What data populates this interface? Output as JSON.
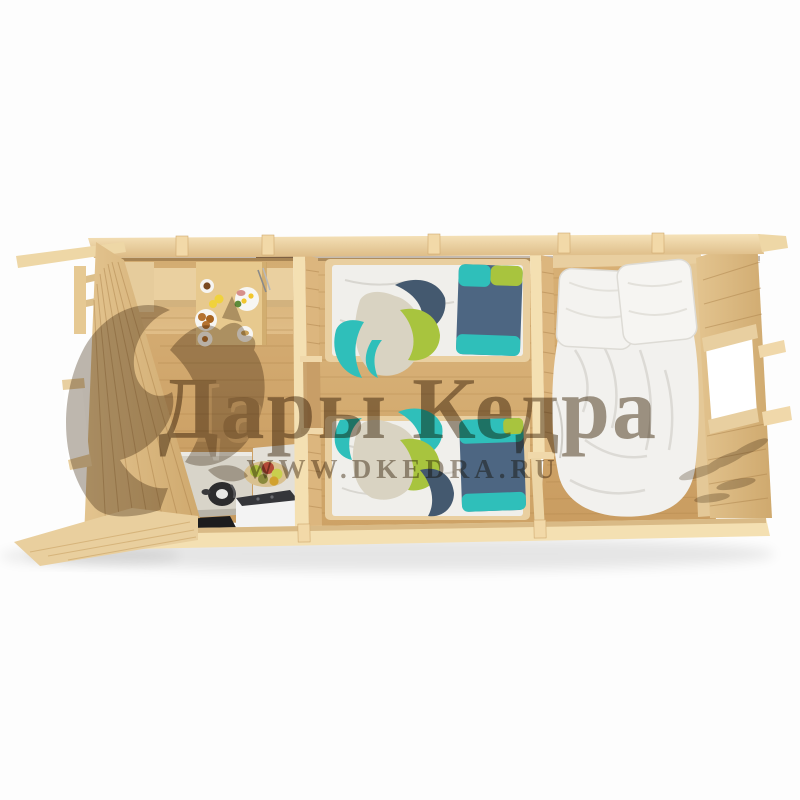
{
  "watermark": {
    "brand_text": "Дары Кедра",
    "url_text": "WWW.DKEDRA.RU",
    "logo": "squirrel-silhouette-icon",
    "brand_color": "#a39889",
    "url_color": "#a79d90"
  },
  "scene": {
    "subject": "top-down 3D cutaway render of a three-room wooden log cabin",
    "style": "product visualization on white background",
    "rooms": [
      {
        "name": "kitchen-dining",
        "position": "left",
        "objects": [
          "corner-bench",
          "dining-table",
          "breakfast-set",
          "kitchen-counter",
          "kettle",
          "black-floor-mat",
          "white-cabinet-with-hob",
          "fruit-basket",
          "window-in-left-wall",
          "entry-opening-in-top-wall"
        ]
      },
      {
        "name": "kids-bedroom",
        "position": "center",
        "objects": [
          "single-bed-top",
          "single-bed-bottom",
          "striped-pillows",
          "draped-blankets",
          "doorway-in-partition"
        ]
      },
      {
        "name": "master-bedroom",
        "position": "right",
        "objects": [
          "double-bed",
          "two-white-pillows",
          "white-duvet",
          "window-in-right-wall",
          "doorway-in-partition"
        ]
      }
    ],
    "palette": {
      "background": "#fdfdfd",
      "wall_cut_top": "#f4dfb1",
      "wood_wall": "#dcb77f",
      "wood_floor": "#cfa468",
      "bench_wood": "#ecd29e",
      "counter_gray": "#d8d4c9",
      "appliance_dark": "#2c2c2e",
      "cabinet_white": "#f3f3f3",
      "textile_teal": "#2fbfba",
      "textile_green": "#a8c43e",
      "textile_blue": "#4d6682",
      "textile_beige": "#d9d3c2",
      "bedding_white": "#f2f1ee"
    }
  }
}
